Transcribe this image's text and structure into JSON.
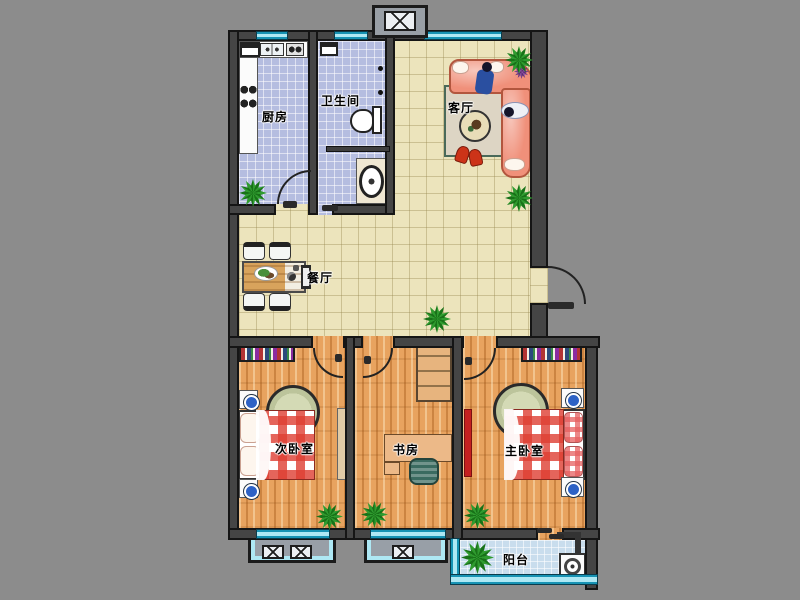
{
  "rooms": {
    "kitchen": {
      "label": "厨房"
    },
    "bathroom": {
      "label": "卫生间"
    },
    "living_room": {
      "label": "客厅"
    },
    "dining_room": {
      "label": "餐厅"
    },
    "second_bedroom": {
      "label": "次卧室"
    },
    "study": {
      "label": "书房"
    },
    "master_bedroom": {
      "label": "主卧室"
    },
    "balcony": {
      "label": "阳台"
    }
  },
  "colors": {
    "background": "#8c8c8c",
    "wall": "#454545",
    "wall_edge": "#151515",
    "tile_beige": "#ece4bc",
    "tile_blue": "#b5bde0",
    "balcony_tile": "#c9dded",
    "wood": "#e8a35f",
    "window_glass": "#aee8f4",
    "window_frame": "#1793b4",
    "sofa": "#f0907a",
    "bed_checker": "#de3e32",
    "rug_green": "#d4dab5",
    "plant": "#2f9b2f"
  }
}
